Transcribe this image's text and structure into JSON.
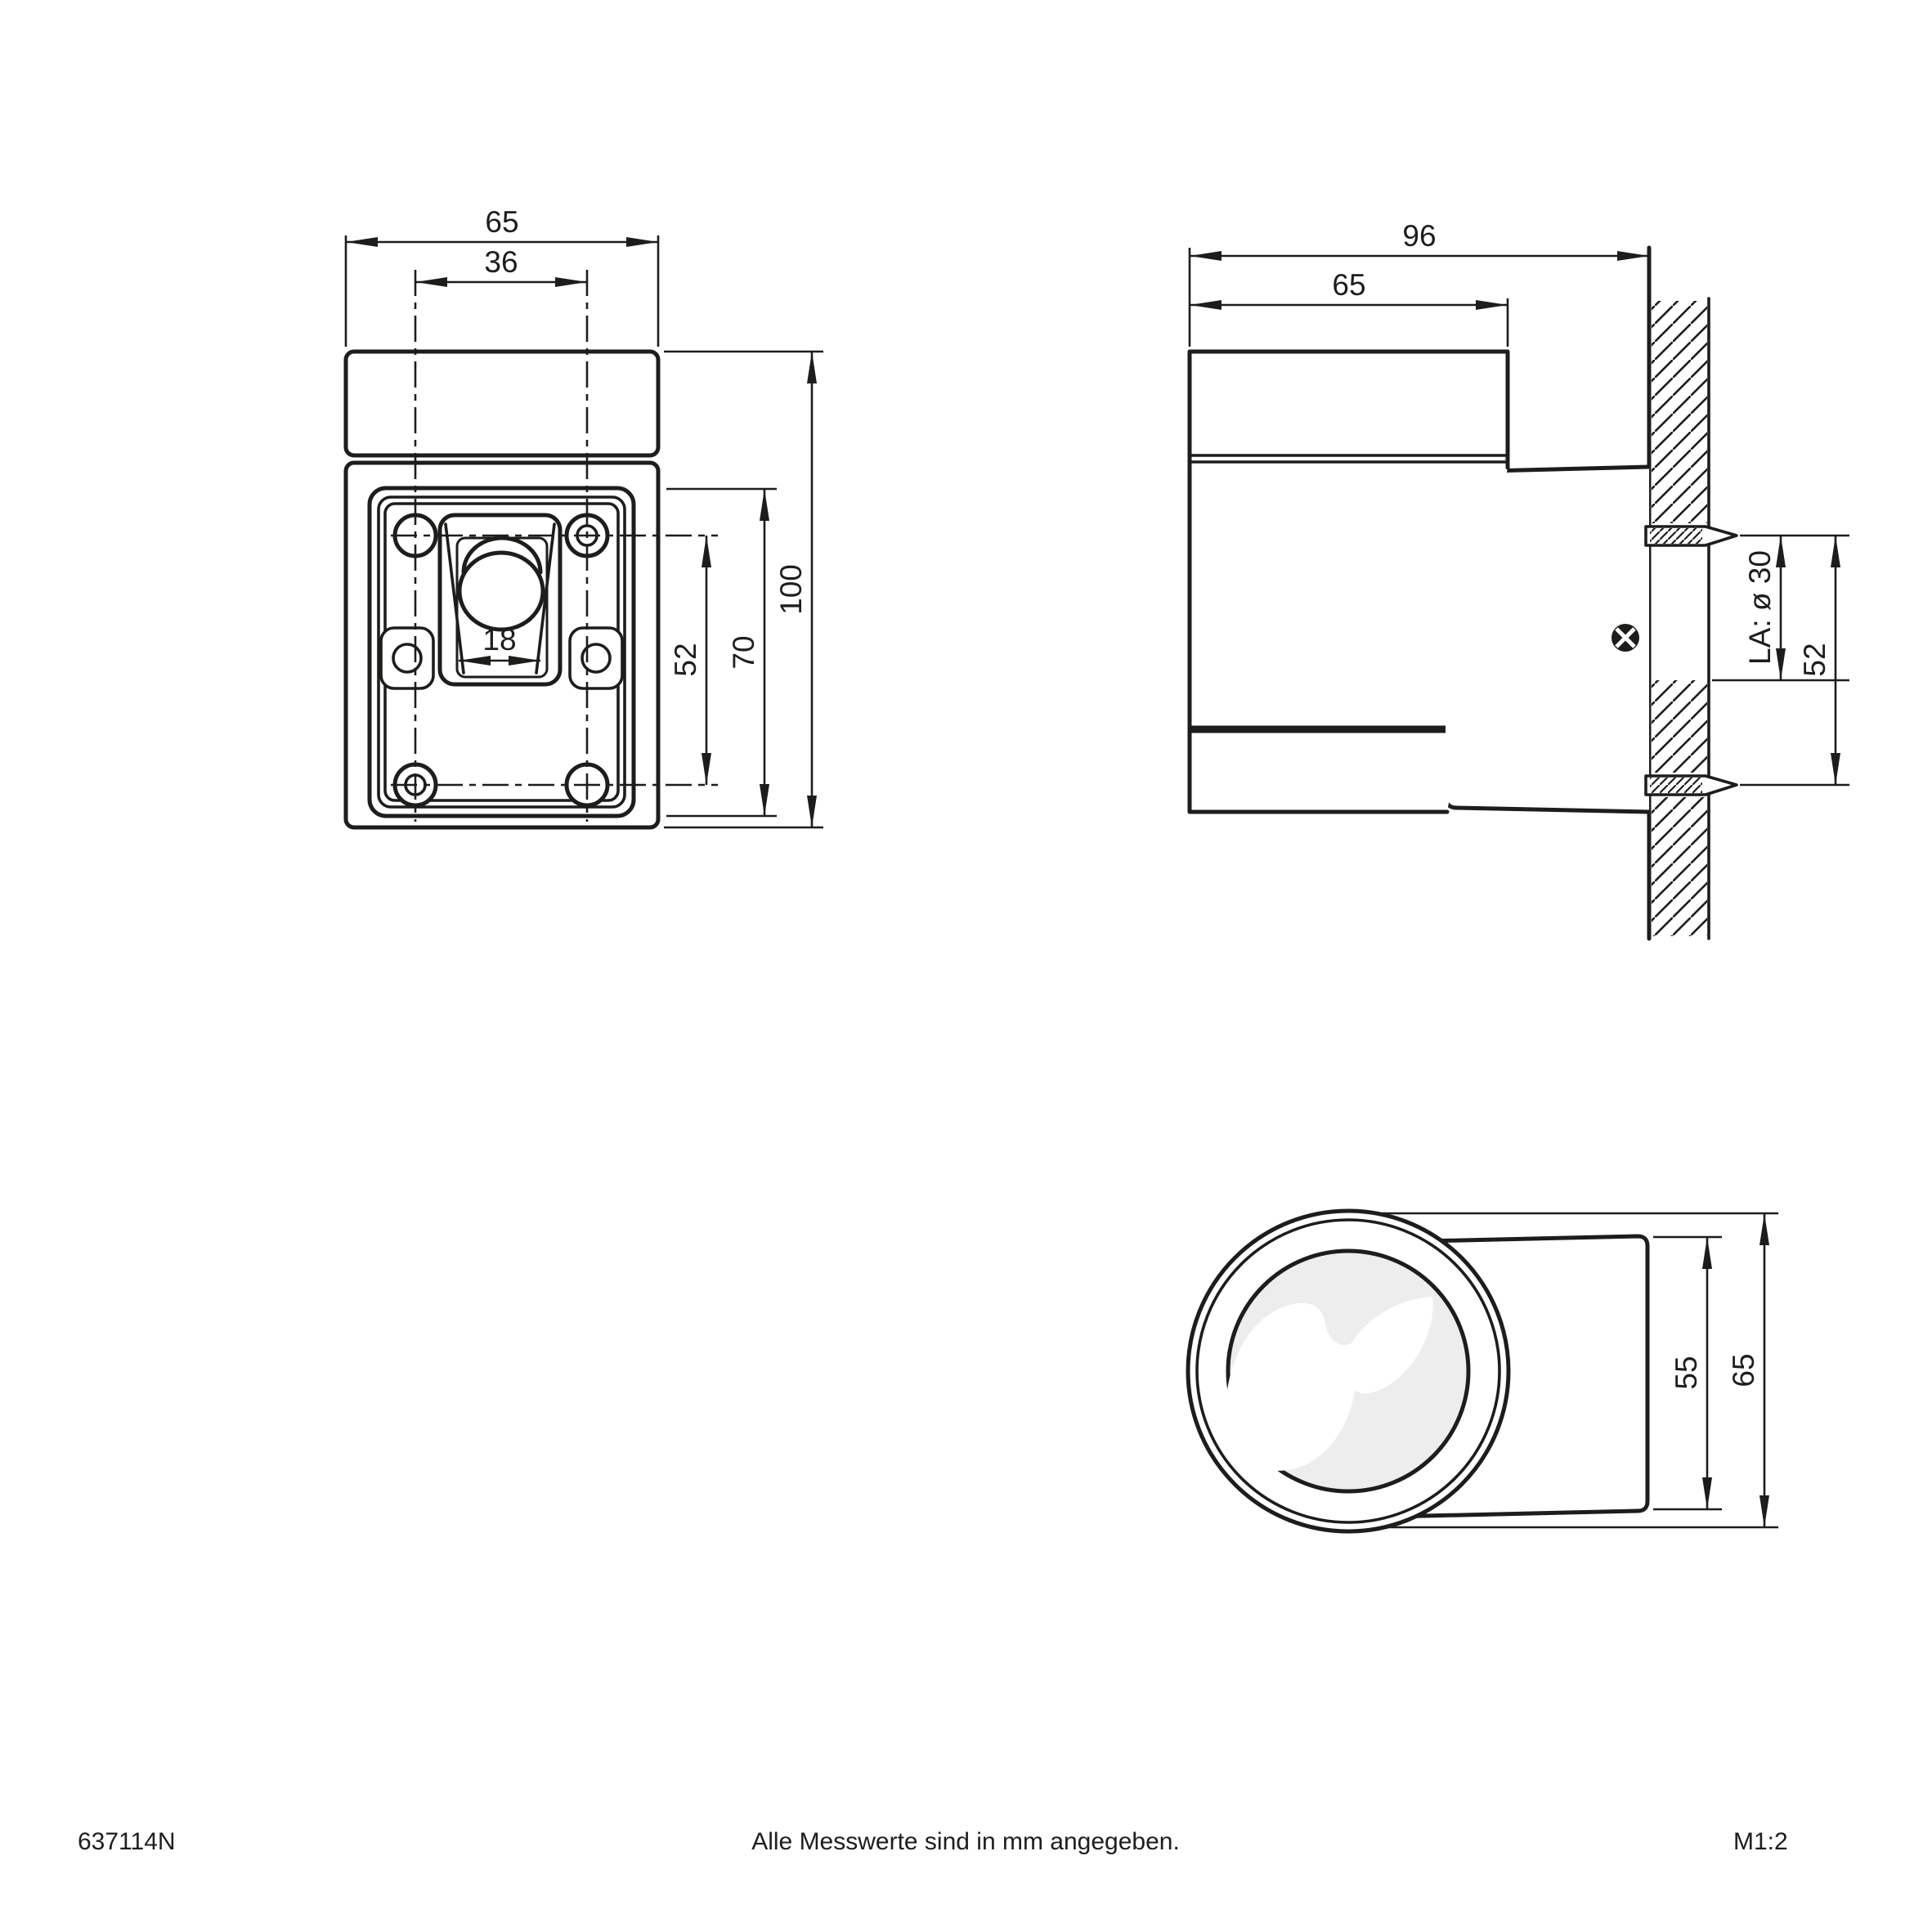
{
  "colors": {
    "line": "#1d1d1b",
    "lens_fill": "#ededed",
    "background": "#ffffff"
  },
  "front_view": {
    "dim_width": "65",
    "dim_hole_spacing_h": "36",
    "dim_lamp_opening": "18",
    "dim_hole_spacing_v": "52",
    "dim_plate_height": "70",
    "dim_height": "100"
  },
  "side_view": {
    "dim_depth": "96",
    "dim_body_depth": "65",
    "dim_wall_hole": "LA: ø 30",
    "dim_hole_spacing_v": "52"
  },
  "bottom_view": {
    "dim_back_diameter": "55",
    "dim_diameter": "65"
  },
  "footer": {
    "article_number": "637114N",
    "units_note": "Alle Messwerte sind in mm angegeben.",
    "scale": "M1:2"
  }
}
